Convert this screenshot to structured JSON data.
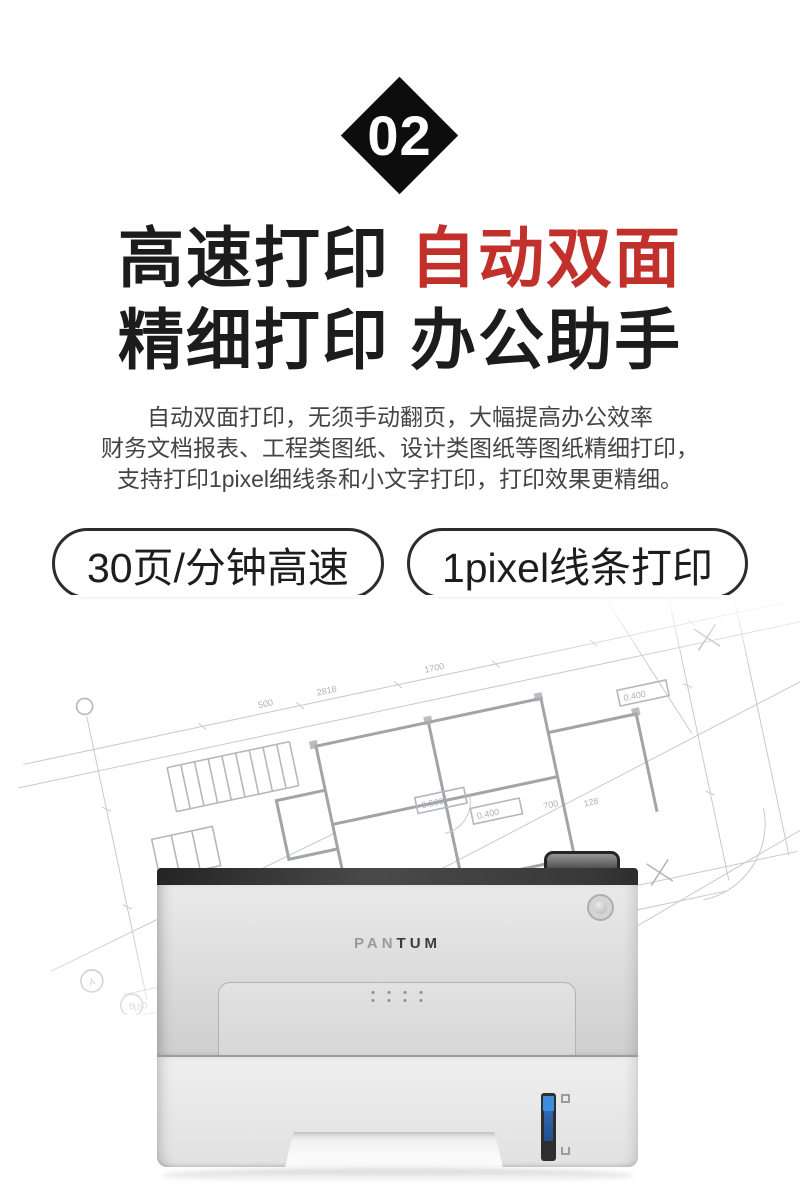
{
  "section": {
    "number": "02"
  },
  "headline": {
    "line1_black": "高速打印",
    "line1_red": "自动双面",
    "line2": "精细打印 办公助手"
  },
  "description": {
    "line1": "自动双面打印，无须手动翻页，大幅提高办公效率",
    "line2": "财务文档报表、工程类图纸、设计类图纸等图纸精细打印，",
    "line3": "支持打印1pixel细线条和小文字打印，打印效果更精细。"
  },
  "badges": [
    {
      "label": "30页/分钟高速"
    },
    {
      "label": "1pixel线条打印"
    }
  ],
  "product": {
    "brand_pan": "PAN",
    "brand_tum": "TUM"
  },
  "colors": {
    "accent_red": "#c2302c",
    "ink": "#1c1c1c",
    "diamond_black": "#0d0d0d"
  },
  "blueprint": {
    "labels": {
      "l1": "0.400",
      "l2": "0.500",
      "l3": "0.400",
      "l4": "2818",
      "l5": "1700",
      "l6": "500",
      "l7": "800",
      "l8": "3000",
      "l9": "1425",
      "l10": "960",
      "l11": "180",
      "l12": "128",
      "l13": "700",
      "l14": "75",
      "l15": "90",
      "lA": "A",
      "lB": "B"
    }
  }
}
